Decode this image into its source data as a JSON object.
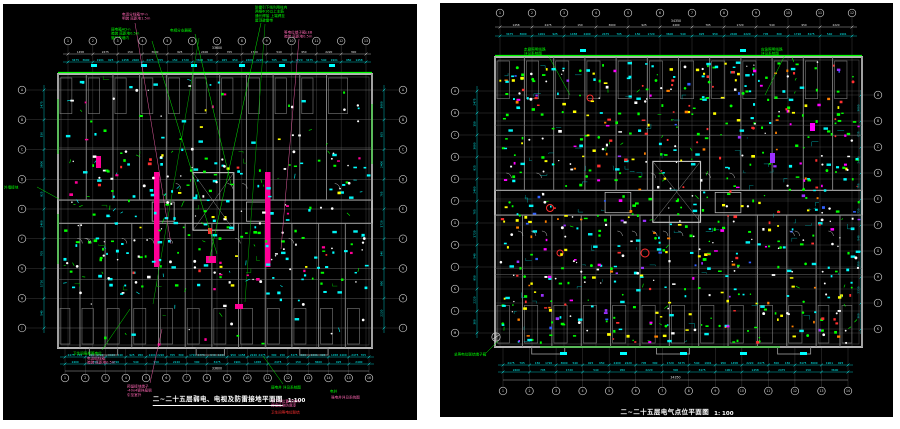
{
  "page": {
    "background": "#ffffff",
    "sheet_background": "#000000"
  },
  "colors": {
    "grid_line": "#6f6f6f",
    "bubble": "#c8c8c8",
    "wall": "#b4b4b4",
    "dim_cyan": "#00ffff",
    "dim_white": "#e8e8e8",
    "green": "#00ff00",
    "pink": "#ff66b3",
    "magenta": "#ff0096",
    "yellow": "#ffff00",
    "red": "#ff3030",
    "orange": "#ff8000",
    "purple": "#9b30ff",
    "blue": "#3060ff",
    "teal": "#009898"
  },
  "panels": [
    {
      "name": "left-drawing",
      "bg": "#000000",
      "rect": {
        "width": 414,
        "height": 416
      },
      "title": {
        "text": "二~二十五层弱电、电视及防雷接地平面图",
        "scale": "1:100"
      },
      "building": {
        "x": 55,
        "y": 70,
        "w": 314,
        "h": 274
      },
      "grids": {
        "top": {
          "y": 37,
          "x0": 65,
          "x1": 363,
          "labels": [
            "1",
            "2",
            "3",
            "4",
            "5",
            "6",
            "7",
            "8",
            "9",
            "10",
            "11",
            "12",
            "13"
          ]
        },
        "bottom": {
          "y": 374,
          "x0": 62,
          "x1": 366,
          "labels": [
            "1",
            "2",
            "3",
            "4",
            "5",
            "6",
            "7",
            "8",
            "9",
            "10",
            "11",
            "12",
            "13",
            "14",
            "15",
            "16"
          ]
        },
        "left": {
          "x": 19,
          "y0": 86,
          "y1": 324,
          "labels": [
            "A",
            "B",
            "C",
            "D",
            "E",
            "F",
            "G",
            "H",
            "J"
          ]
        },
        "right": {
          "x": 400,
          "y0": 86,
          "y1": 324,
          "labels": [
            "A",
            "B",
            "C",
            "D",
            "E",
            "F",
            "G",
            "H",
            "J"
          ]
        }
      },
      "dims": {
        "topWhiteY": 50,
        "topCyanY": 58,
        "bottomCyanY1": 353,
        "bottomCyanY2": 360,
        "bottomWhiteY": 367,
        "leftX": 41,
        "rightX": 381,
        "totalTop": "33600",
        "totalBottom": "33600",
        "numbers": [
          "3475",
          "1901",
          "1458",
          "2475",
          "150",
          "3600",
          "925",
          "2400",
          "705",
          "1720",
          "540",
          "950",
          "2220",
          "300"
        ]
      },
      "walls": {
        "topF": [
          0,
          0.09,
          0.175,
          0.26,
          0.345,
          0.43,
          0.515,
          0.6,
          0.685,
          0.77,
          0.855,
          1
        ],
        "botF": [
          0,
          0.07,
          0.15,
          0.235,
          0.32,
          0.405,
          0.49,
          0.575,
          0.66,
          0.745,
          0.83,
          0.915,
          1
        ],
        "dense": false
      },
      "overlays": {
        "rects": [
          {
            "x": 151,
            "y": 168,
            "w": 5.5,
            "h": 95,
            "fill": "#ff0096"
          },
          {
            "x": 262,
            "y": 168,
            "w": 5.5,
            "h": 95,
            "fill": "#ff0096"
          },
          {
            "x": 203,
            "y": 252,
            "w": 10,
            "h": 7,
            "fill": "#ff0096"
          },
          {
            "x": 93,
            "y": 152,
            "w": 5,
            "h": 12,
            "fill": "#ff0096"
          },
          {
            "x": 232,
            "y": 300,
            "w": 8,
            "h": 5,
            "fill": "#ff0096"
          },
          {
            "x": 205,
            "y": 224,
            "w": 4,
            "h": 6,
            "fill": "#ff3030"
          },
          {
            "x": 88,
            "y": 60,
            "w": 6,
            "h": 3,
            "fill": "#00ffff"
          },
          {
            "x": 138,
            "y": 60,
            "w": 6,
            "h": 3,
            "fill": "#00ffff"
          },
          {
            "x": 188,
            "y": 60,
            "w": 6,
            "h": 3,
            "fill": "#00ffff"
          },
          {
            "x": 236,
            "y": 60,
            "w": 6,
            "h": 3,
            "fill": "#00ffff"
          },
          {
            "x": 276,
            "y": 60,
            "w": 6,
            "h": 3,
            "fill": "#00ffff"
          },
          {
            "x": 326,
            "y": 60,
            "w": 6,
            "h": 3,
            "fill": "#00ffff"
          }
        ],
        "lines": [
          {
            "x1": 55,
            "y1": 68.5,
            "x2": 369,
            "y2": 68.5,
            "s": "#00ff00",
            "w": 1.3
          },
          {
            "x1": 55,
            "y1": 95,
            "x2": 55,
            "y2": 150,
            "s": "#00c000",
            "w": 1
          },
          {
            "x1": 55,
            "y1": 210,
            "x2": 55,
            "y2": 260,
            "s": "#00c000",
            "w": 1
          },
          {
            "x1": 369,
            "y1": 100,
            "x2": 369,
            "y2": 160,
            "s": "#00c000",
            "w": 1
          },
          {
            "x1": 262,
            "y1": 20,
            "x2": 242,
            "y2": 298,
            "s": "#00b000",
            "w": 0.5
          },
          {
            "x1": 196,
            "y1": 34,
            "x2": 150,
            "y2": 300,
            "s": "#00b000",
            "w": 0.5
          }
        ],
        "circles": []
      },
      "scatter": [
        {
          "color": "#00ff00",
          "n": 70,
          "kind": "sq"
        },
        {
          "color": "#00ff00",
          "n": 30,
          "kind": "tick"
        },
        {
          "color": "#00c000",
          "n": 18,
          "kind": "wire"
        },
        {
          "color": "#00ffff",
          "n": 80,
          "kind": "sq"
        },
        {
          "color": "#00ffff",
          "n": 30,
          "kind": "label"
        },
        {
          "color": "#00ffff",
          "n": 25,
          "kind": "tick"
        },
        {
          "color": "#ffffff",
          "n": 70,
          "kind": "dot"
        },
        {
          "color": "#ffffff",
          "n": 20,
          "kind": "sq"
        },
        {
          "color": "#ff0096",
          "n": 22,
          "kind": "sq"
        },
        {
          "color": "#ffff00",
          "n": 14,
          "kind": "sq"
        },
        {
          "color": "#ff3030",
          "n": 8,
          "kind": "sq"
        }
      ],
      "arcs": 12,
      "seed": 11,
      "bias": true,
      "annotations": [
        {
          "x": 119,
          "y": 8,
          "color": "#ff66b3",
          "lines": [
            "电话分线箱TP-n",
            "明装 底距地1.5m"
          ],
          "leader": [
            132,
            19,
            168,
            240
          ]
        },
        {
          "x": 108,
          "y": 23,
          "color": "#00ff00",
          "lines": [
            "弱电箱AD-n",
            "暗装 底距地0.5m",
            "管暗敷墙内"
          ],
          "leader": [
            149,
            37,
            214,
            250
          ]
        },
        {
          "x": 167,
          "y": 24,
          "color": "#00ff00",
          "lines": [
            "电视分支器箱"
          ],
          "leader": [
            192,
            30,
            228,
            180
          ]
        },
        {
          "x": 252,
          "y": 1,
          "color": "#00ff00",
          "lines": [
            "防雷引下线利用柱内",
            "两根Φ16以上主筋",
            "通长焊接 上端焊至",
            "屋顶避雷带"
          ],
          "leader": [
            258,
            19,
            206,
            257
          ]
        },
        {
          "x": 281,
          "y": 26,
          "color": "#ff66b3",
          "lines": [
            "等电位端子箱LEB",
            "暗装 底距地0.5m"
          ],
          "leader": [
            296,
            35,
            278,
            245
          ]
        },
        {
          "x": 1,
          "y": 181,
          "color": "#00ff00",
          "lines": [
            "外墙接地"
          ],
          "leader": [
            34,
            183,
            56,
            195
          ]
        },
        {
          "x": 70,
          "y": 347,
          "color": "#00ff00",
          "lines": [
            "卫生间局部等电位"
          ],
          "leader": [
            99,
            346,
            127,
            305
          ]
        },
        {
          "x": 84,
          "y": 352,
          "color": "#ff66b3",
          "lines": [
            "电话组线箱",
            "暗装 底距地0.5m"
          ]
        },
        {
          "x": 124,
          "y": 380,
          "color": "#ff66b3",
          "lines": [
            "预留接地端子",
            "-40x4镀锌扁钢",
            "引至室外"
          ],
          "leader": [
            147,
            379,
            159,
            325
          ]
        },
        {
          "x": 268,
          "y": 381,
          "color": "#00ff00",
          "lines": [
            "弱电井 详见系统图"
          ],
          "leader": [
            280,
            380,
            260,
            352
          ]
        },
        {
          "x": 268,
          "y": 395,
          "color": "#ff66b3",
          "lines": [
            "引下线位置见结构",
            "焊接处刷防腐漆"
          ]
        },
        {
          "x": 268,
          "y": 406,
          "color": "#ff3030",
          "lines": [
            "卫生间等电位联结"
          ]
        },
        {
          "x": 327,
          "y": 385,
          "color": "#00ff00",
          "lines": [
            "电井"
          ]
        },
        {
          "x": 328,
          "y": 391,
          "color": "#ff66b3",
          "lines": [
            "强电井详见系统图"
          ]
        }
      ]
    },
    {
      "name": "right-drawing",
      "bg": "#000000",
      "rect": {
        "width": 453,
        "height": 414
      },
      "title": {
        "text": "二~二十五层电气点位平面图",
        "scale": "1: 100"
      },
      "building": {
        "x": 55,
        "y": 54,
        "w": 367,
        "h": 290
      },
      "grids": {
        "top": {
          "y": 10,
          "x0": 60,
          "x1": 412,
          "labels": [
            "1",
            "2",
            "3",
            "4",
            "5",
            "6",
            "7",
            "8",
            "9",
            "10",
            "11",
            "12"
          ]
        },
        "bottom": {
          "y": 388,
          "x0": 63,
          "x1": 408,
          "labels": [
            "1",
            "2",
            "3",
            "4",
            "5",
            "6",
            "7",
            "8",
            "9",
            "10",
            "11",
            "12",
            "13",
            "14"
          ]
        },
        "left": {
          "x": 15,
          "y0": 88,
          "y1": 330,
          "labels": [
            "A",
            "B",
            "C",
            "D",
            "E",
            "F",
            "G",
            "H",
            "J",
            "K",
            "L",
            "M"
          ]
        },
        "right": {
          "x": 438,
          "y0": 92,
          "y1": 326,
          "labels": [
            "A",
            "B",
            "C",
            "D",
            "E",
            "F",
            "G",
            "H",
            "J",
            "K"
          ]
        }
      },
      "dims": {
        "topWhiteY": 24,
        "topCyanY": 33,
        "bottomCyanY1": 362,
        "bottomCyanY2": 369,
        "bottomWhiteY": 377,
        "leftX": 37,
        "rightX": 421,
        "totalTop": "34350",
        "totalBottom": "34350",
        "numbers": [
          "3475",
          "1901",
          "1458",
          "2475",
          "150",
          "3600",
          "925",
          "2400",
          "705",
          "1720",
          "540",
          "950",
          "2220",
          "300"
        ]
      },
      "walls": {
        "topF": [
          0,
          0.08,
          0.16,
          0.245,
          0.33,
          0.415,
          0.5,
          0.585,
          0.67,
          0.755,
          0.84,
          0.92,
          1
        ],
        "botF": [
          0,
          0.075,
          0.155,
          0.235,
          0.315,
          0.395,
          0.475,
          0.555,
          0.635,
          0.715,
          0.795,
          0.875,
          0.94,
          1
        ],
        "dense": true
      },
      "overlays": {
        "rects": [
          {
            "x": 120,
            "y": 349,
            "w": 7,
            "h": 3,
            "fill": "#00ffff"
          },
          {
            "x": 180,
            "y": 349,
            "w": 7,
            "h": 3,
            "fill": "#00ffff"
          },
          {
            "x": 240,
            "y": 349,
            "w": 7,
            "h": 3,
            "fill": "#00ffff"
          },
          {
            "x": 300,
            "y": 349,
            "w": 7,
            "h": 3,
            "fill": "#00ffff"
          },
          {
            "x": 360,
            "y": 349,
            "w": 7,
            "h": 3,
            "fill": "#00ffff"
          },
          {
            "x": 140,
            "y": 46,
            "w": 6,
            "h": 3,
            "fill": "#00ffff"
          },
          {
            "x": 300,
            "y": 46,
            "w": 6,
            "h": 3,
            "fill": "#00ffff"
          },
          {
            "x": 330,
            "y": 150,
            "w": 5,
            "h": 10,
            "fill": "#9b30ff"
          },
          {
            "x": 370,
            "y": 120,
            "w": 5,
            "h": 8,
            "fill": "#ff00ff"
          }
        ],
        "lines": [
          {
            "x1": 55,
            "y1": 52.5,
            "x2": 422,
            "y2": 52.5,
            "s": "#00ff00",
            "w": 1.3
          },
          {
            "x1": 100,
            "y1": 344,
            "x2": 340,
            "y2": 344,
            "s": "#00c000",
            "w": 1
          },
          {
            "x1": 56,
            "y1": 338,
            "x2": 56,
            "y2": 330,
            "s": "#d8d8d8",
            "w": 0.6
          },
          {
            "x1": 53,
            "y1": 336,
            "x2": 59,
            "y2": 332,
            "s": "#d8d8d8",
            "w": 0.6
          }
        ],
        "circles": [
          {
            "cx": 56,
            "cy": 334,
            "r": 4.2,
            "s": "#d8d8d8",
            "w": 0.7
          },
          {
            "cx": 110,
            "cy": 205,
            "r": 3.5,
            "s": "#ff3030",
            "w": 1
          },
          {
            "cx": 150,
            "cy": 95,
            "r": 3,
            "s": "#ff3030",
            "w": 1
          },
          {
            "cx": 205,
            "cy": 250,
            "r": 4,
            "s": "#ff3030",
            "w": 1
          },
          {
            "cx": 120,
            "cy": 250,
            "r": 3,
            "s": "#ff3030",
            "w": 1
          }
        ]
      },
      "scatter": [
        {
          "color": "#00ff00",
          "n": 150,
          "kind": "sq"
        },
        {
          "color": "#00ff00",
          "n": 60,
          "kind": "dot"
        },
        {
          "color": "#00ff00",
          "n": 30,
          "kind": "tick"
        },
        {
          "color": "#ffff00",
          "n": 80,
          "kind": "sq"
        },
        {
          "color": "#ff8000",
          "n": 40,
          "kind": "sq"
        },
        {
          "color": "#00ffff",
          "n": 90,
          "kind": "sq"
        },
        {
          "color": "#00ffff",
          "n": 45,
          "kind": "label"
        },
        {
          "color": "#00b0b0",
          "n": 35,
          "kind": "wire"
        },
        {
          "color": "#ffffff",
          "n": 90,
          "kind": "dot"
        },
        {
          "color": "#ffffff",
          "n": 30,
          "kind": "sq"
        },
        {
          "color": "#ff3030",
          "n": 45,
          "kind": "sq"
        },
        {
          "color": "#ff3030",
          "n": 15,
          "kind": "dot"
        },
        {
          "color": "#ff00ff",
          "n": 35,
          "kind": "sq"
        },
        {
          "color": "#9b30ff",
          "n": 22,
          "kind": "sq"
        },
        {
          "color": "#3060ff",
          "n": 18,
          "kind": "sq"
        },
        {
          "color": "#009898",
          "n": 30,
          "kind": "wire"
        }
      ],
      "arcs": 16,
      "seed": 23,
      "bias": false,
      "annotations": [
        {
          "x": 84,
          "y": 44,
          "color": "#00ff00",
          "lines": [
            "走廊照明线路",
            "详见系统图"
          ],
          "leader": [
            108,
            52,
            130,
            92
          ]
        },
        {
          "x": 321,
          "y": 44,
          "color": "#00ff00",
          "lines": [
            "应急照明线路",
            "详见系统图"
          ],
          "leader": [
            345,
            52,
            325,
            92
          ]
        },
        {
          "x": 14,
          "y": 349,
          "color": "#00ff00",
          "lines": [
            "总等电位联结端子箱"
          ],
          "leader": [
            46,
            350,
            58,
            338
          ]
        }
      ]
    }
  ]
}
